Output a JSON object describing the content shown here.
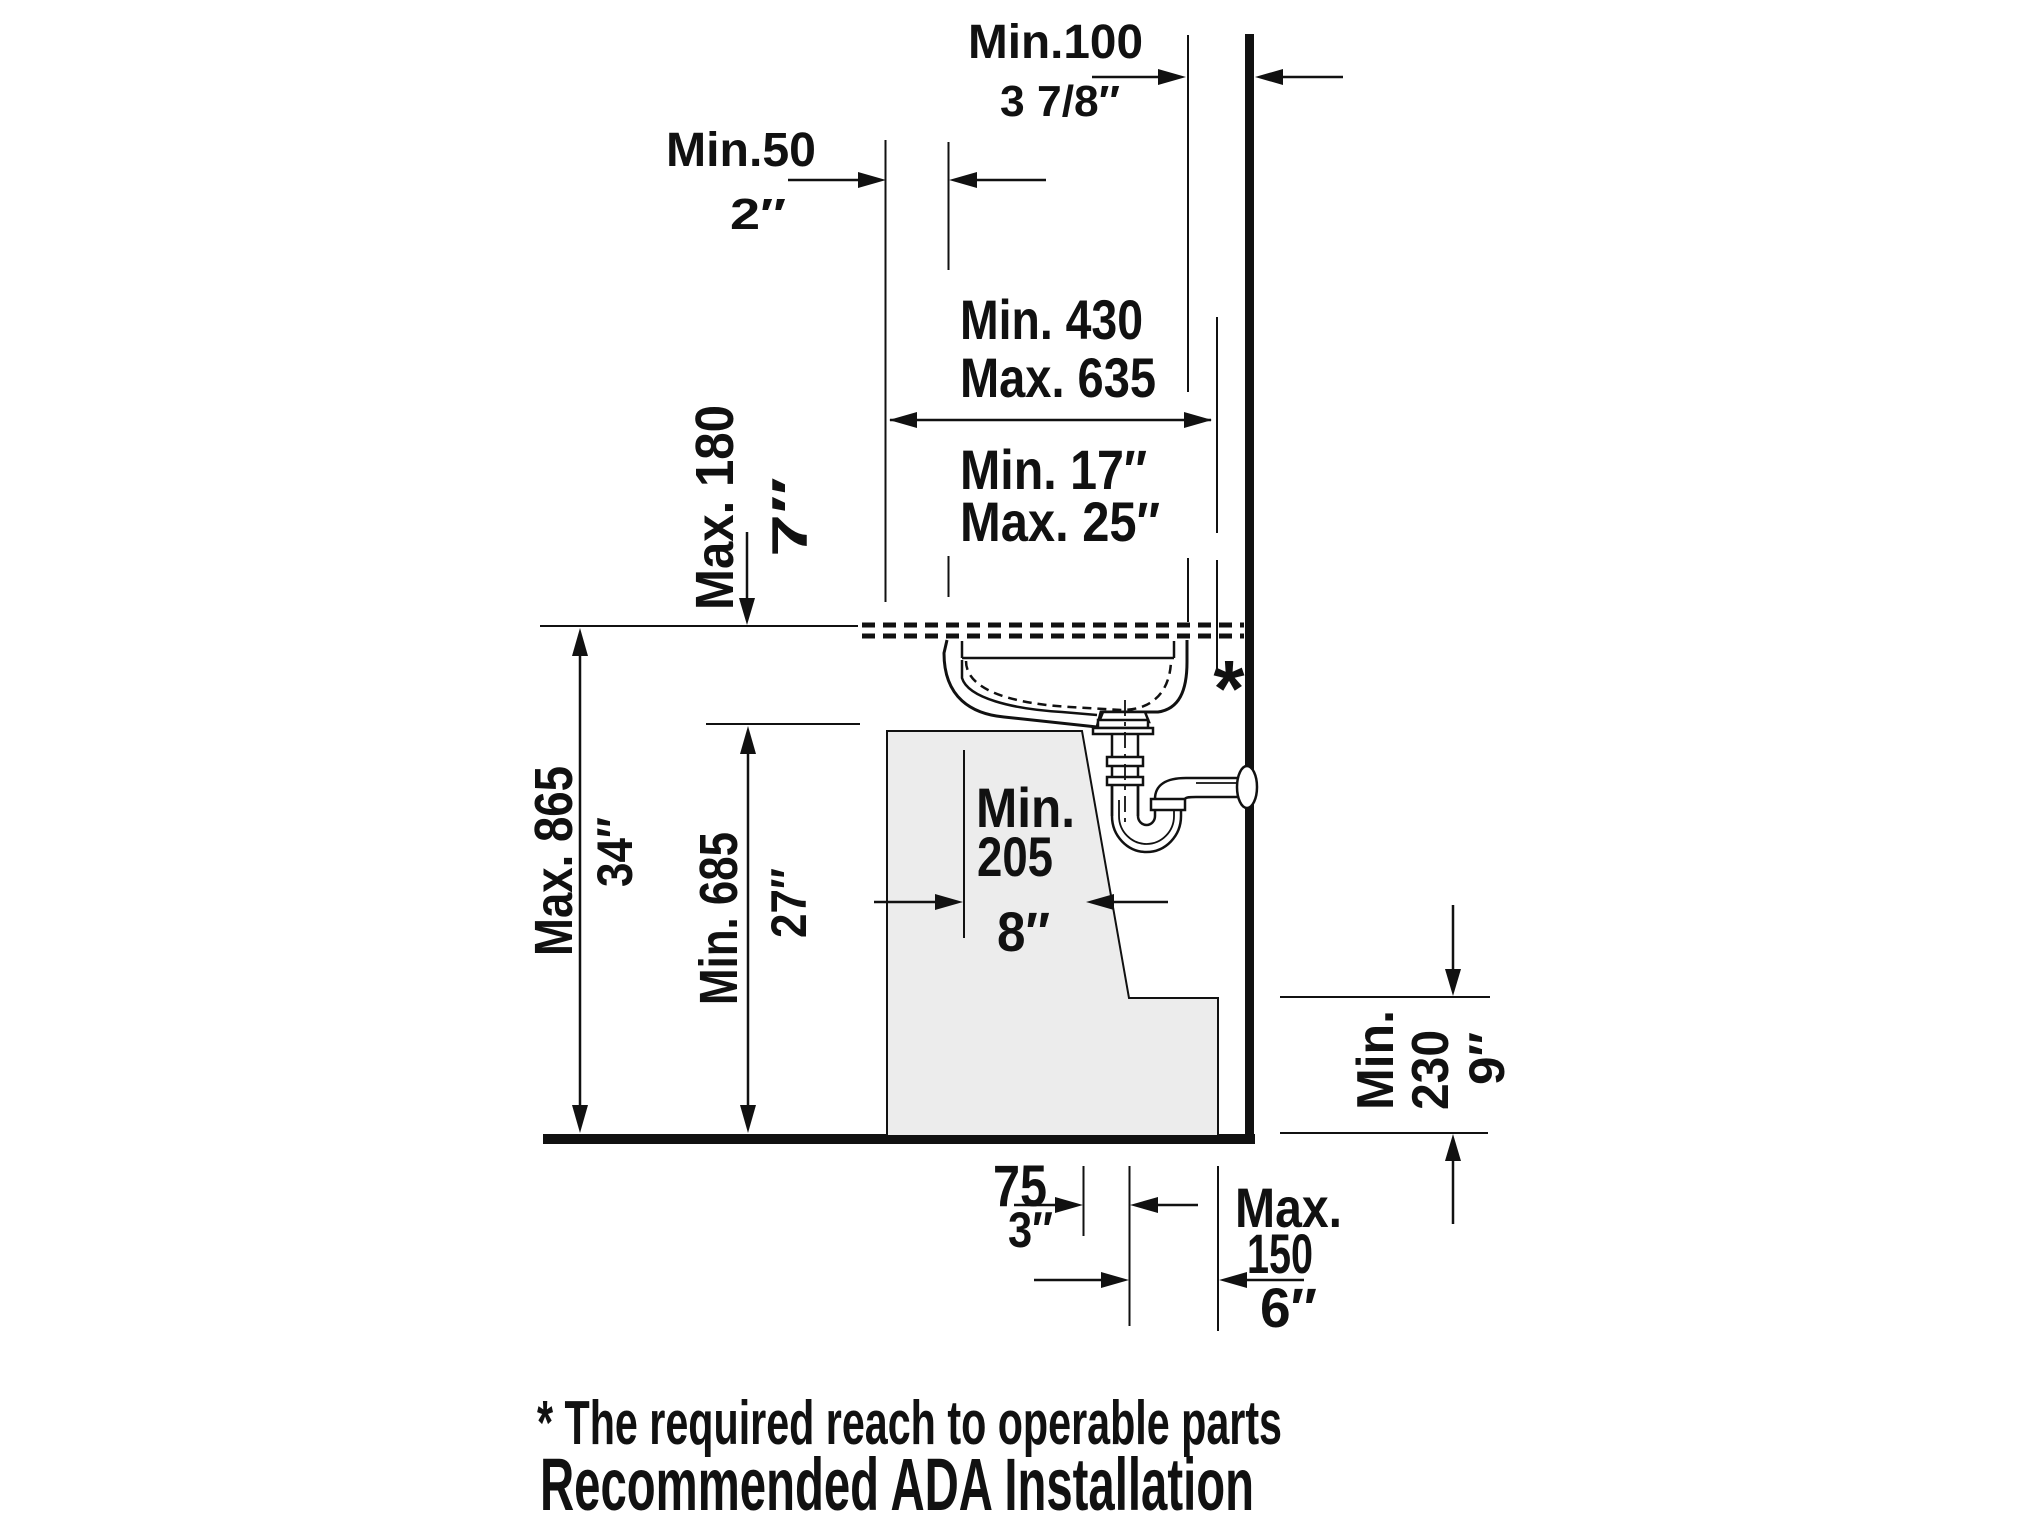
{
  "title": "Recommended ADA Installation",
  "footnote": "* The required reach to operable parts",
  "reach_marker": "*",
  "colors": {
    "line": "#111111",
    "clearance_fill": "#ececec",
    "background": "#ffffff"
  },
  "dims": {
    "wall_clearance": {
      "metric": "Min.100",
      "imperial": "3 7/8″"
    },
    "overhang": {
      "metric": "Min.50",
      "imperial": "2″"
    },
    "reach": {
      "metric_min": "Min. 430",
      "metric_max": "Max. 635",
      "imperial_min": "Min. 17″",
      "imperial_max": "Max. 25″"
    },
    "apron_drop": {
      "metric": "Max. 180",
      "imperial": "7″"
    },
    "rim_height": {
      "metric": "Max. 865",
      "imperial": "34″"
    },
    "knee_clearance": {
      "metric": "Min. 685",
      "imperial": "27″"
    },
    "knee_depth": {
      "metric_word": "Min.",
      "metric_value": "205",
      "imperial": "8″"
    },
    "toe_offset": {
      "metric": "75",
      "imperial": "3″"
    },
    "toe_clearance": {
      "metric_word": "Min.",
      "metric_value": "230",
      "imperial": "9″"
    },
    "toe_depth": {
      "metric_word": "Max.",
      "metric_value": "150",
      "imperial": "6″"
    }
  }
}
